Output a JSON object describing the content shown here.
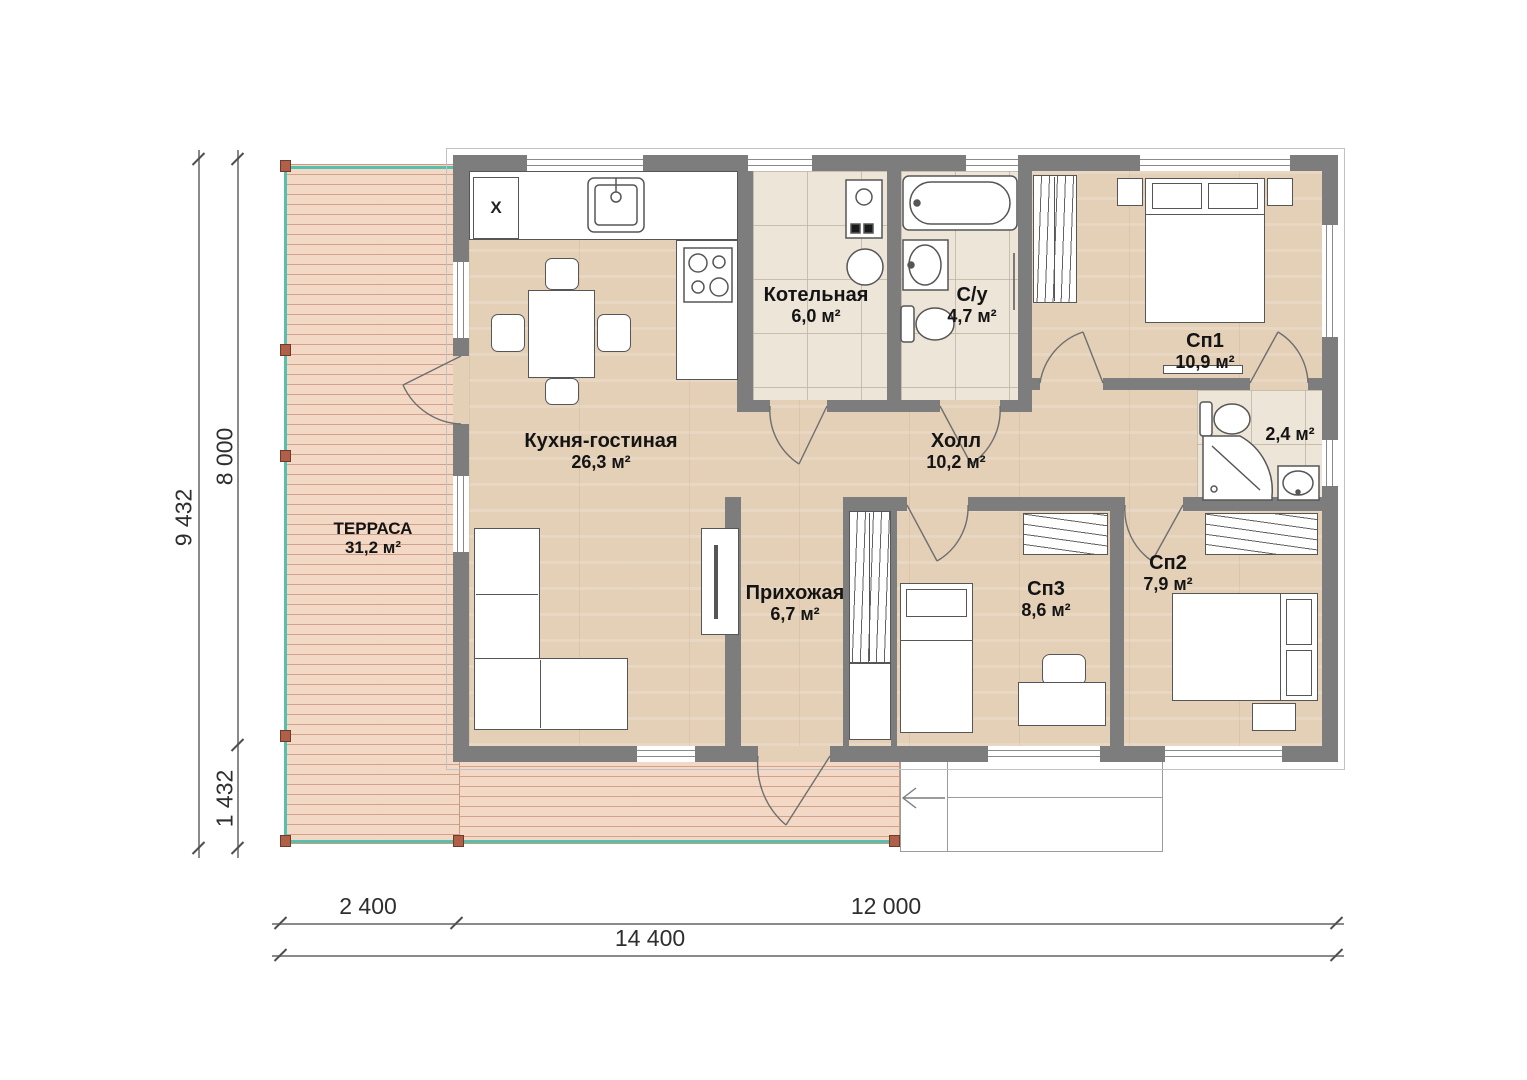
{
  "rooms": {
    "terrace": {
      "name": "ТЕРРАСА",
      "area": "31,2 м²"
    },
    "kitchen_living": {
      "name": "Кухня-гостиная",
      "area": "26,3 м²"
    },
    "boiler": {
      "name": "Котельная",
      "area": "6,0 м²"
    },
    "bathroom": {
      "name": "С/у",
      "area": "4,7 м²"
    },
    "hall": {
      "name": "Холл",
      "area": "10,2 м²"
    },
    "bedroom1": {
      "name": "Сп1",
      "area": "10,9 м²"
    },
    "shower_room": {
      "area": "2,4 м²"
    },
    "hallway": {
      "name": "Прихожая",
      "area": "6,7 м²"
    },
    "bedroom3": {
      "name": "Сп3",
      "area": "8,6 м²"
    },
    "bedroom2": {
      "name": "Сп2",
      "area": "7,9 м²"
    }
  },
  "dimensions": {
    "vertical_total": "9 432",
    "vertical_main": "8 000",
    "vertical_terrace": "1 432",
    "horizontal_terrace": "2 400",
    "horizontal_main": "12 000",
    "horizontal_total": "14 400"
  },
  "markers": {
    "fridge": "X"
  },
  "colors": {
    "wall": "#7d7d7d",
    "deck": "#f3d9c5",
    "rail": "#56bfae",
    "wood": "#e4cfb7",
    "tile": "#ece5d8"
  }
}
